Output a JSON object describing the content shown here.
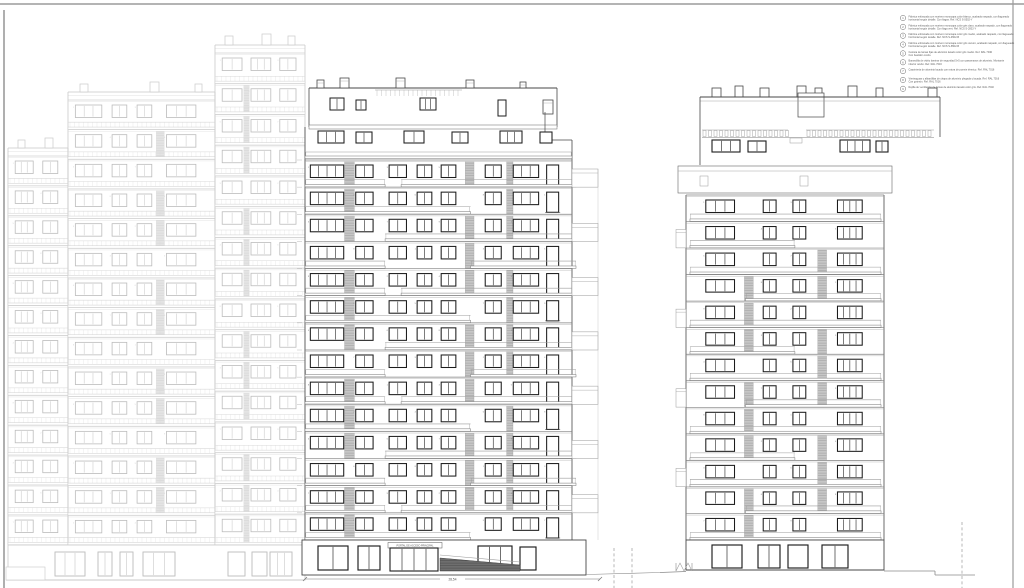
{
  "sheet": {
    "background": "#ffffff",
    "frame_color": "#9b9b9b",
    "width_px": 1024,
    "height_px": 588
  },
  "colors": {
    "dark_line": "#474747",
    "window_frame": "#1c1c1c",
    "slab_line": "#808080",
    "rail_line": "#9c9c9c",
    "faint_line": "#c9c9c9",
    "faint_frame": "#bcbcbc",
    "hatch_fill": "#c6c6c6",
    "hatch_line": "#9f9f9f",
    "faint_hatch_fill": "#e4e4e4",
    "ramp_fill": "#6e6e6e",
    "tiny_number": "#7a7a7a",
    "legend_text": "#5a5a5a",
    "ground_line": "#8a8a8a"
  },
  "annotations": {
    "dimension_label": "28,54",
    "entrance_sign": "PORTAL DE ACCESO PRINCIPAL"
  },
  "legend": {
    "items": [
      {
        "num": "1",
        "line1": "Fábrica enfoscada con mortero monocapa color blanco, acabado raspado, con llagueado",
        "line2": "horizontal según detalle. Con llagas. Ref. NCS S-0502-Y"
      },
      {
        "num": "2",
        "line1": "Fábrica enfoscada con mortero monocapa color gris claro, acabado raspado, con llagueado",
        "line2": "horizontal según detalle. Con llaga vert. Ref. NCS S-2002-Y"
      },
      {
        "num": "3",
        "line1": "Fábrica enfoscada con mortero monocapa color gris medio, acabado raspado, con llagueado",
        "line2": "horizontal según detalle. Ref. NCS S-4502-B"
      },
      {
        "num": "4",
        "line1": "Fábrica enfoscada con mortero monocapa color gris oscuro, acabado raspado, con llagueado",
        "line2": "horizontal según detalle. Ref. NCS S-6502-B"
      },
      {
        "num": "5",
        "line1": "Celosía de lamas fijas de aluminio lacado color gris medio. Ref. RAL 7040",
        "line2": "Con bastidor oculto."
      },
      {
        "num": "6",
        "line1": "Barandilla de vidrio laminar de seguridad 5+5 con pasamanos de aluminio. Montante",
        "line2": "inferior oculto. Ref. RAL 7016"
      },
      {
        "num": "7",
        "line1": "Carpintería de aluminio lacado con rotura de puente térmico. Ref. RAL 7016",
        "line2": ""
      },
      {
        "num": "8",
        "line1": "Vierteaguas y albardillas de chapa de aluminio plegada y lacada. Ref. RAL 7016",
        "line2": "Con goterón. Ref. RAL 7016"
      },
      {
        "num": "9",
        "line1": "Rejilla de ventilación de lamas de aluminio lacado color gris. Ref. RAL 7040",
        "line2": ""
      }
    ]
  },
  "elevations": {
    "left": {
      "name": "adjacent-elevation-faint",
      "x": 8,
      "right": 305,
      "ground_top": 545,
      "ground_bottom": 580,
      "sections": [
        {
          "x": 8,
          "w": 60,
          "top": 148,
          "bodyTop": 156,
          "floors": 13,
          "floorH": 29.92,
          "cols": [
            {
              "x": 0.12,
              "w": 0.3,
              "p": 3
            },
            {
              "x": 0.58,
              "w": 0.25,
              "p": 2
            }
          ],
          "chimneys": [
            [
              18,
              140,
              7,
              8
            ],
            [
              45,
              138,
              8,
              10
            ]
          ]
        },
        {
          "x": 68,
          "w": 147,
          "top": 92,
          "bodyTop": 100,
          "floors": 15,
          "floorH": 29.67,
          "cols": [
            {
              "x": 0.05,
              "w": 0.18,
              "p": 3
            },
            {
              "x": 0.3,
              "w": 0.1,
              "p": 2
            },
            {
              "x": 0.47,
              "w": 0.1,
              "p": 2
            },
            {
              "x": 0.67,
              "w": 0.2,
              "p": 3
            }
          ],
          "strips": [
            {
              "x": 0.6,
              "w": 0.055,
              "mod": 3,
              "off": 1,
              "min": 1
            }
          ],
          "chimneys": [
            [
              80,
              84,
              8,
              8
            ],
            [
              150,
              82,
              9,
              10
            ],
            [
              195,
              84,
              7,
              8
            ]
          ]
        },
        {
          "x": 215,
          "w": 90,
          "top": 45,
          "bodyTop": 53,
          "floors": 16,
          "floorH": 30.75,
          "cols": [
            {
              "x": 0.08,
              "w": 0.22,
              "p": 2
            },
            {
              "x": 0.4,
              "w": 0.22,
              "p": 3
            },
            {
              "x": 0.72,
              "w": 0.18,
              "p": 2
            }
          ],
          "strips": [
            {
              "x": 0.32,
              "w": 0.06,
              "mod": 4,
              "off": 0,
              "min": 1
            }
          ],
          "chimneys": [
            [
              225,
              36,
              8,
              9
            ],
            [
              262,
              34,
              9,
              11
            ],
            [
              288,
              36,
              7,
              9
            ]
          ]
        }
      ],
      "storefronts": [
        [
          55,
          552,
          30,
          24,
          3
        ],
        [
          98,
          552,
          14,
          24,
          2
        ],
        [
          120,
          552,
          13,
          24,
          2
        ],
        [
          143,
          552,
          32,
          24,
          3
        ],
        [
          228,
          552,
          17,
          24,
          1
        ],
        [
          252,
          552,
          15,
          24,
          1
        ],
        [
          270,
          552,
          22,
          24,
          3
        ]
      ]
    },
    "middle": {
      "name": "main-elevation-center",
      "x": 305,
      "w": 267,
      "top": 88,
      "bodyTop": 160,
      "floors": 14,
      "floorH": 27.142,
      "ground_top": 540,
      "ground_bottom": 575,
      "cols": [
        {
          "x": 0.02,
          "w": 0.125,
          "p": 4
        },
        {
          "x": 0.19,
          "w": 0.065,
          "p": 2
        },
        {
          "x": 0.315,
          "w": 0.065,
          "p": 2
        },
        {
          "x": 0.42,
          "w": 0.055,
          "p": 2
        },
        {
          "x": 0.51,
          "w": 0.055,
          "p": 2
        },
        {
          "x": 0.675,
          "w": 0.06,
          "p": 2
        },
        {
          "x": 0.78,
          "w": 0.095,
          "p": 3
        },
        {
          "x": 0.905,
          "w": 0.045,
          "p": 1,
          "door": true
        }
      ],
      "strips": [
        {
          "x": 0.148,
          "w": 0.037,
          "mod": 4,
          "off": 1
        },
        {
          "x": 0.6,
          "w": 0.033,
          "mod": 4,
          "off": 3
        },
        {
          "x": 0.755,
          "w": 0.024,
          "mod": 5,
          "off": 2
        }
      ],
      "balconies": [
        [
          [
            0.0,
            0.3
          ],
          [
            0.36,
            1.0
          ]
        ],
        [
          [
            0.0,
            0.62
          ]
        ],
        [
          [
            0.3,
            1.0
          ]
        ],
        [
          [
            0.0,
            0.3
          ],
          [
            0.62,
            1.0
          ]
        ]
      ],
      "penthouse_chimneys": [
        [
          317,
          80,
          7,
          8
        ],
        [
          340,
          78,
          9,
          10
        ],
        [
          396,
          78,
          9,
          10
        ],
        [
          466,
          80,
          8,
          8
        ],
        [
          520,
          82,
          6,
          6
        ],
        [
          543,
          100,
          10,
          14
        ]
      ],
      "top_floor_windows": [
        [
          318,
          131,
          26,
          12,
          3
        ],
        [
          356,
          132,
          16,
          11,
          2
        ],
        [
          404,
          131,
          20,
          12,
          2
        ],
        [
          452,
          132,
          16,
          11,
          2
        ],
        [
          500,
          131,
          22,
          12,
          3
        ],
        [
          540,
          132,
          12,
          11,
          1
        ]
      ],
      "storefronts": [
        [
          318,
          546,
          30,
          24,
          2
        ],
        [
          358,
          546,
          22,
          24,
          2
        ],
        [
          478,
          546,
          34,
          24,
          3
        ],
        [
          520,
          547,
          16,
          23,
          1
        ]
      ],
      "entrance_door": [
        390,
        548,
        48,
        23,
        4
      ],
      "sign_box": [
        388,
        542.5,
        54,
        5.5
      ],
      "ramp": [
        440,
        558,
        520,
        571
      ]
    },
    "right": {
      "name": "main-elevation-right",
      "x": 686,
      "w": 198,
      "top": 97,
      "bodyTop": 195,
      "floors": 13,
      "floorH": 26.538,
      "ground_top": 540,
      "ground_bottom": 570,
      "cols": [
        {
          "x": 0.1,
          "w": 0.145,
          "p": 3
        },
        {
          "x": 0.39,
          "w": 0.065,
          "p": 2
        },
        {
          "x": 0.54,
          "w": 0.065,
          "p": 2
        },
        {
          "x": 0.765,
          "w": 0.125,
          "p": 4
        }
      ],
      "strips": [
        {
          "x": 0.295,
          "w": 0.045,
          "mod": 4,
          "off": 2,
          "min": 2
        },
        {
          "x": 0.665,
          "w": 0.045,
          "mod": 4,
          "off": 0,
          "min": 2
        }
      ],
      "balconies": [
        [
          [
            0.02,
            0.985
          ]
        ],
        [
          [
            0.02,
            0.55
          ]
        ],
        [
          [
            0.02,
            0.985
          ]
        ],
        [
          [
            0.3,
            0.985
          ]
        ]
      ],
      "roof_chimneys": [
        [
          712,
          88,
          9,
          9
        ],
        [
          735,
          86,
          8,
          11
        ],
        [
          760,
          88,
          9,
          9
        ],
        [
          797,
          86,
          9,
          11
        ],
        [
          815,
          88,
          7,
          9
        ],
        [
          848,
          86,
          9,
          11
        ],
        [
          876,
          88,
          7,
          9
        ],
        [
          928,
          88,
          9,
          9
        ]
      ],
      "top_floor_windows": [
        [
          712,
          140,
          28,
          12,
          3
        ],
        [
          748,
          141,
          18,
          11,
          2
        ],
        [
          840,
          140,
          30,
          12,
          4
        ],
        [
          876,
          141,
          12,
          11,
          2
        ]
      ],
      "storefronts": [
        [
          712,
          545,
          30,
          23,
          2
        ],
        [
          758,
          545,
          22,
          23,
          2
        ],
        [
          788,
          545,
          20,
          23,
          1
        ],
        [
          822,
          545,
          26,
          23,
          2
        ]
      ]
    }
  }
}
